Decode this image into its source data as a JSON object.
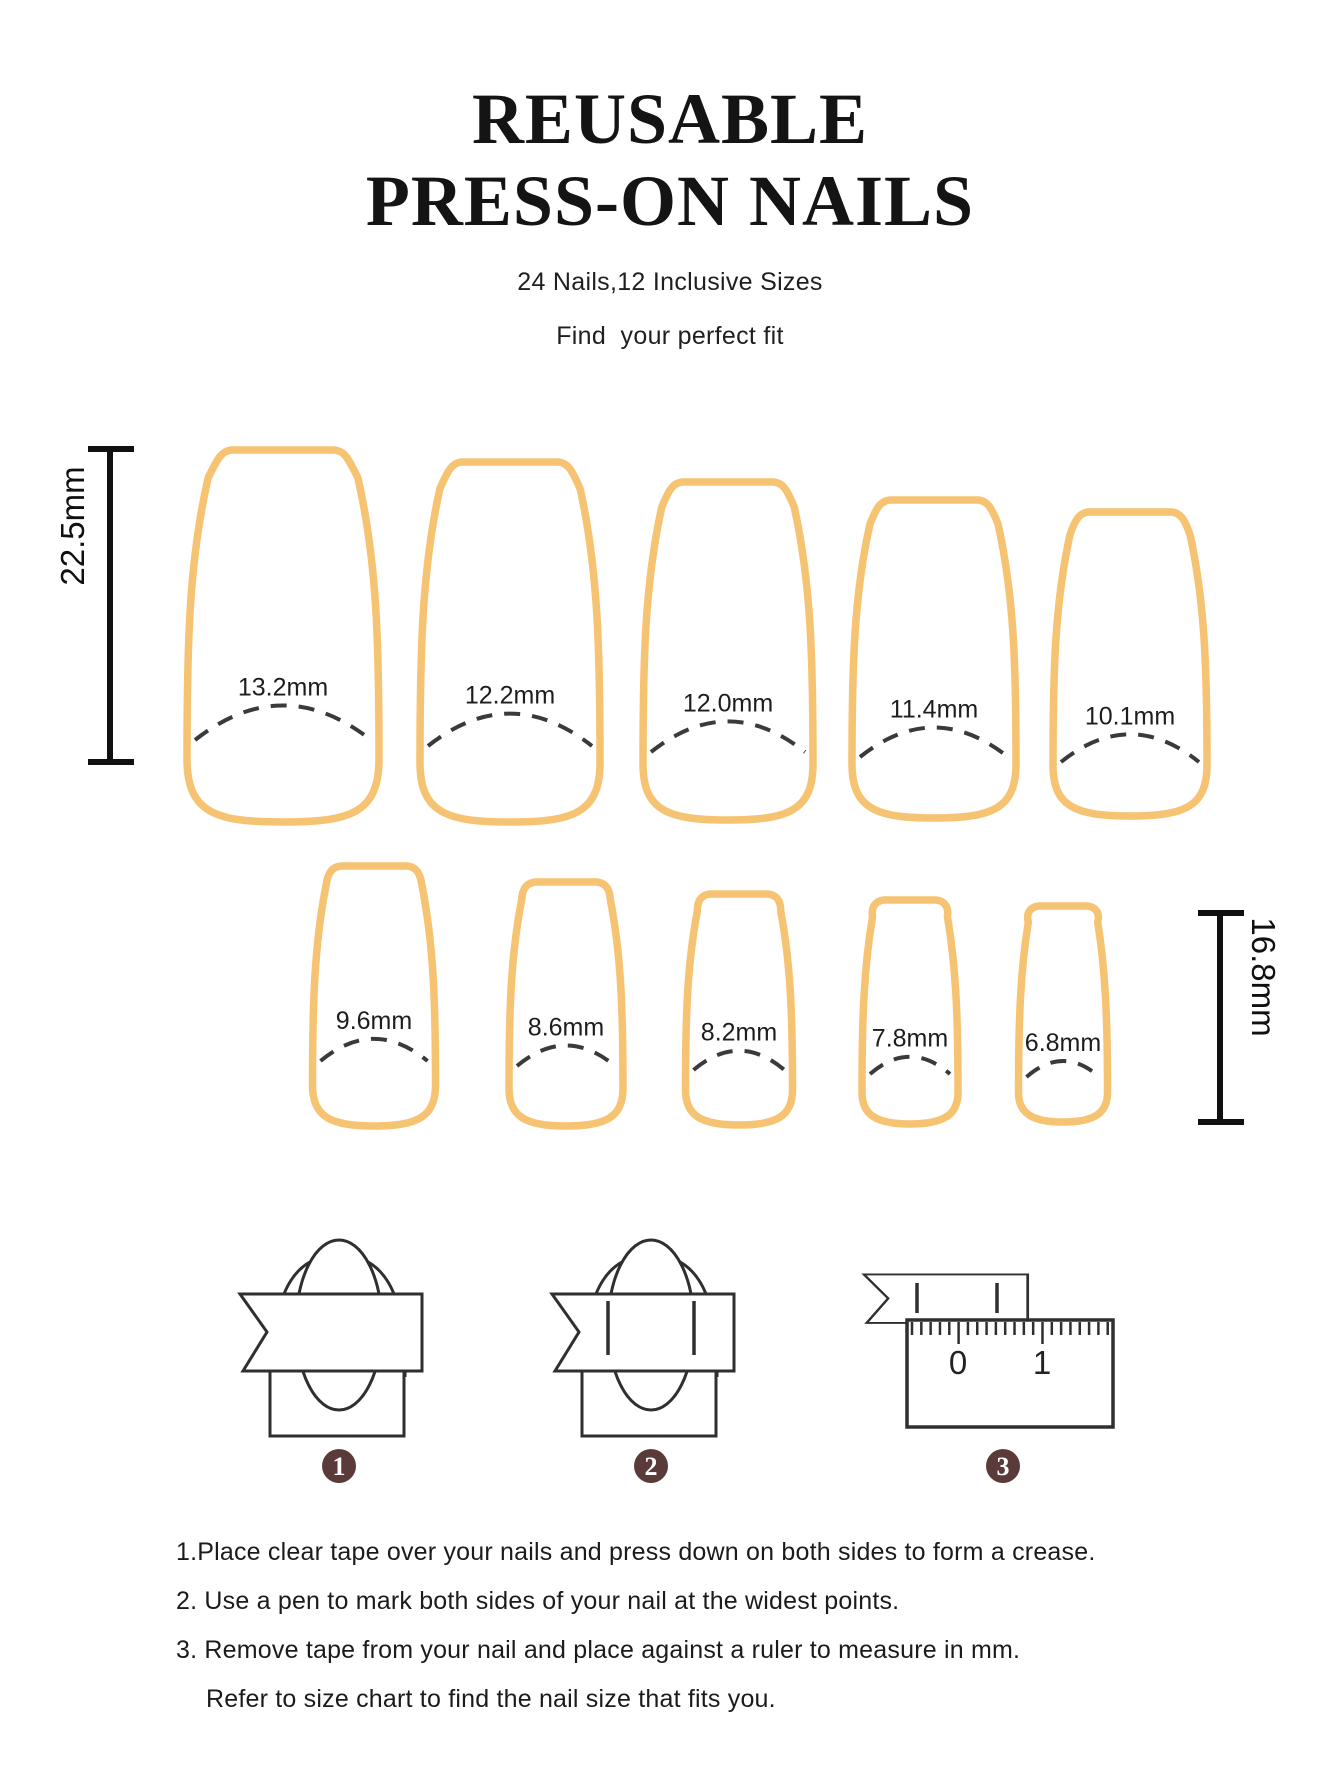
{
  "header": {
    "title_line1": "REUSABLE",
    "title_line2": "PRESS-ON NAILS",
    "subtitle": "24 Nails,12 Inclusive Sizes",
    "tagline": "Find  your perfect fit"
  },
  "rulers": {
    "left_label": "22.5mm",
    "right_label": "16.8mm"
  },
  "chart": {
    "nail_color": "#F5C372",
    "badge_color": "#5a3b39",
    "rows": [
      {
        "ruler_label": "22.5mm",
        "nails": [
          {
            "label": "13.2mm",
            "width_mm": 13.2,
            "cx": 283,
            "top": 450,
            "bottom": 822,
            "w": 192,
            "arc_y": 740
          },
          {
            "label": "12.2mm",
            "width_mm": 12.2,
            "cx": 510,
            "top": 462,
            "bottom": 822,
            "w": 180,
            "arc_y": 746
          },
          {
            "label": "12.0mm",
            "width_mm": 12.0,
            "cx": 728,
            "top": 482,
            "bottom": 820,
            "w": 170,
            "arc_y": 752
          },
          {
            "label": "11.4mm",
            "width_mm": 11.4,
            "cx": 934,
            "top": 500,
            "bottom": 818,
            "w": 164,
            "arc_y": 757
          },
          {
            "label": "10.1mm",
            "width_mm": 10.1,
            "cx": 1130,
            "top": 512,
            "bottom": 816,
            "w": 154,
            "arc_y": 762
          }
        ]
      },
      {
        "ruler_label": "16.8mm",
        "nails": [
          {
            "label": "9.6mm",
            "width_mm": 9.6,
            "cx": 374,
            "top": 866,
            "bottom": 1126,
            "w": 123,
            "arc_y": 1061
          },
          {
            "label": "8.6mm",
            "width_mm": 8.6,
            "cx": 566,
            "top": 882,
            "bottom": 1126,
            "w": 114,
            "arc_y": 1066
          },
          {
            "label": "8.2mm",
            "width_mm": 8.2,
            "cx": 739,
            "top": 894,
            "bottom": 1125,
            "w": 107,
            "arc_y": 1070
          },
          {
            "label": "7.8mm",
            "width_mm": 7.8,
            "cx": 910,
            "top": 900,
            "bottom": 1124,
            "w": 96,
            "arc_y": 1074
          },
          {
            "label": "6.8mm",
            "width_mm": 6.8,
            "cx": 1063,
            "top": 906,
            "bottom": 1122,
            "w": 89,
            "arc_y": 1077
          }
        ]
      }
    ]
  },
  "steps": {
    "badges": [
      "1",
      "2",
      "3"
    ],
    "ruler_numbers": [
      "0",
      "1"
    ],
    "instructions": [
      "1.Place clear tape over your nails and press down on both sides to form a crease.",
      "2. Use a pen to mark both sides of your nail at the widest points.",
      "3. Remove tape from your nail and place against a ruler to measure in mm.",
      "Refer to size chart to find the nail size that fits you."
    ]
  }
}
